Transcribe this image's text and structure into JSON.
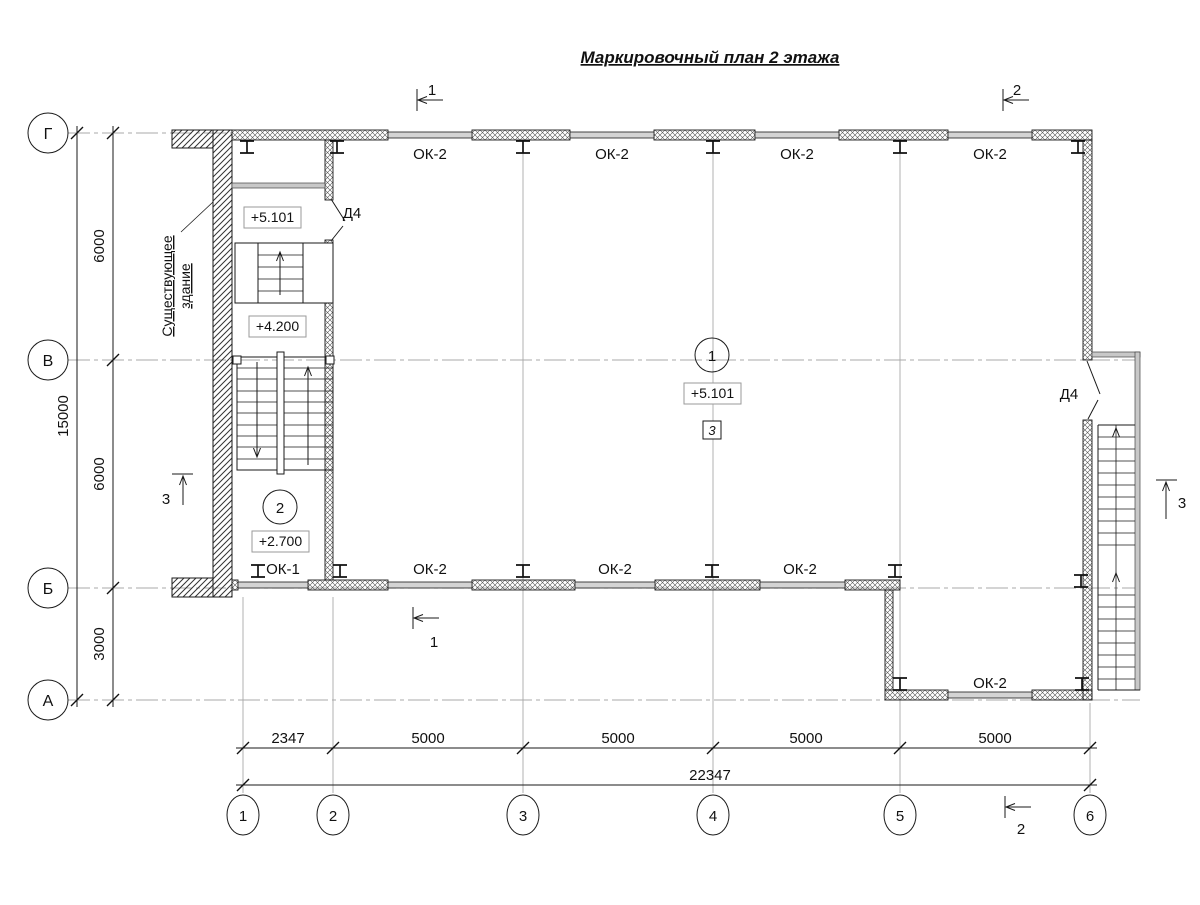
{
  "title": "Маркировочный план 2 этажа",
  "axis_rows": [
    "Г",
    "В",
    "Б",
    "А"
  ],
  "axis_cols": [
    "1",
    "2",
    "3",
    "4",
    "5",
    "6"
  ],
  "dims": {
    "left_segments": [
      "6000",
      "6000",
      "3000"
    ],
    "left_total": "15000",
    "bottom_segments": [
      "2347",
      "5000",
      "5000",
      "5000",
      "5000"
    ],
    "bottom_total": "22347"
  },
  "windows": {
    "top": [
      "ОК-2",
      "ОК-2",
      "ОК-2",
      "ОК-2"
    ],
    "middle": [
      "ОК-1",
      "ОК-2",
      "ОК-2",
      "ОК-2"
    ],
    "bottom": "ОК-2"
  },
  "doors": {
    "stair_door": "Д4",
    "right_door": "Д4"
  },
  "levels": {
    "upper_landing": "+5.101",
    "mid_landing": "+4.200",
    "room2": "+2.700",
    "hall": "+5.101"
  },
  "rooms": {
    "hall": "1",
    "stair": "2",
    "hall_note": "3"
  },
  "sections": {
    "s1": "1",
    "s2": "2",
    "s3": "3"
  },
  "notes": {
    "existing_line1": "Существующее",
    "existing_line2": "здание"
  },
  "colors": {
    "line": "#1a1a1a",
    "grid": "#a8a8a8",
    "window_fill": "#d4d4d4",
    "background": "#ffffff"
  }
}
